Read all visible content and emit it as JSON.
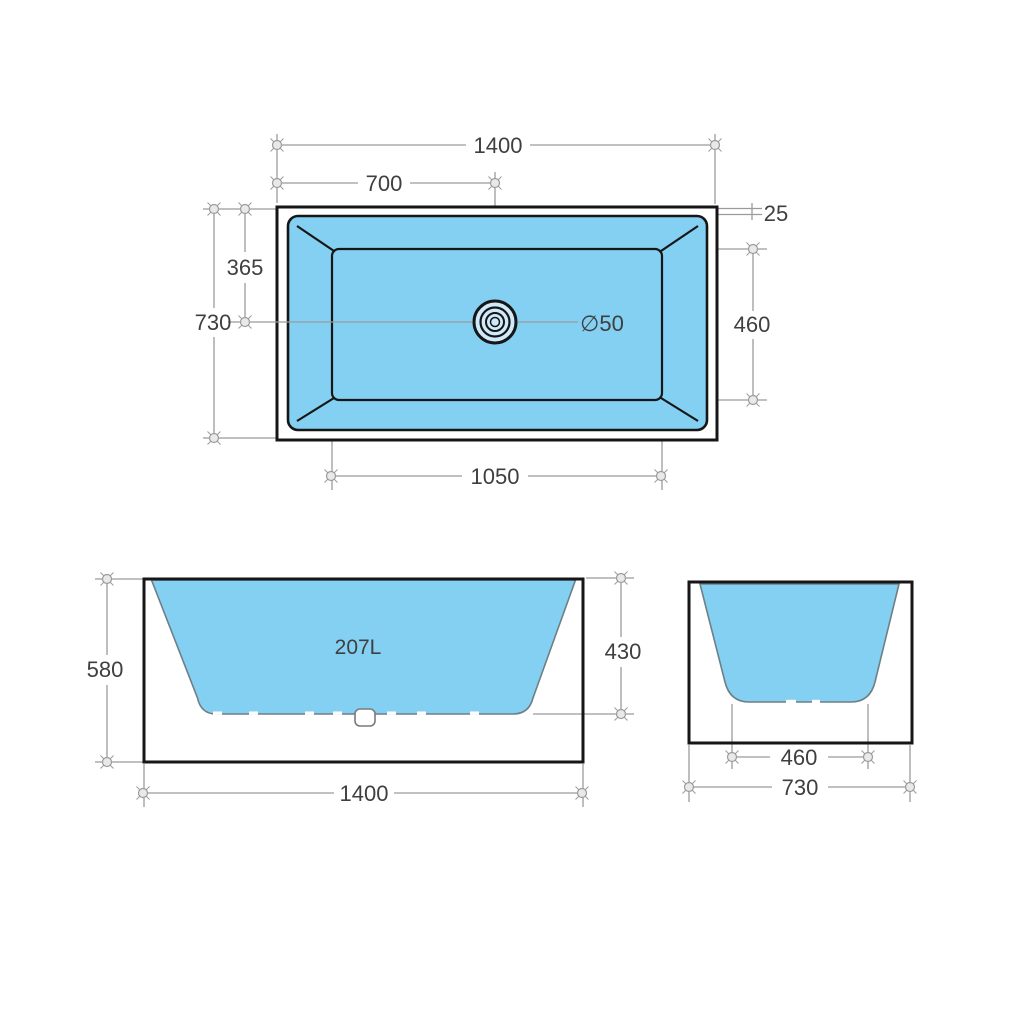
{
  "drawing": {
    "type": "bathtub-technical-drawing",
    "views": [
      "top-view",
      "front-view",
      "side-view"
    ]
  },
  "colors": {
    "water": "#83D0F2",
    "drain_inner": "#cfeafa",
    "outline": "#161616",
    "water_edge": "#6f7f86",
    "dimension": "#9b9b9b",
    "label": "#3f3f3f",
    "background": "#ffffff"
  },
  "top_view": {
    "overall_length": "1400",
    "drain_offset_length": "700",
    "overall_width": "730",
    "drain_offset_width": "365",
    "rim_width": "25",
    "base_width": "460",
    "base_length": "1050",
    "drain_diameter": "∅50"
  },
  "front_view": {
    "capacity": "207L",
    "overall_height": "580",
    "inner_depth": "430",
    "overall_length": "1400"
  },
  "side_view": {
    "base_width": "460",
    "overall_width": "730"
  }
}
